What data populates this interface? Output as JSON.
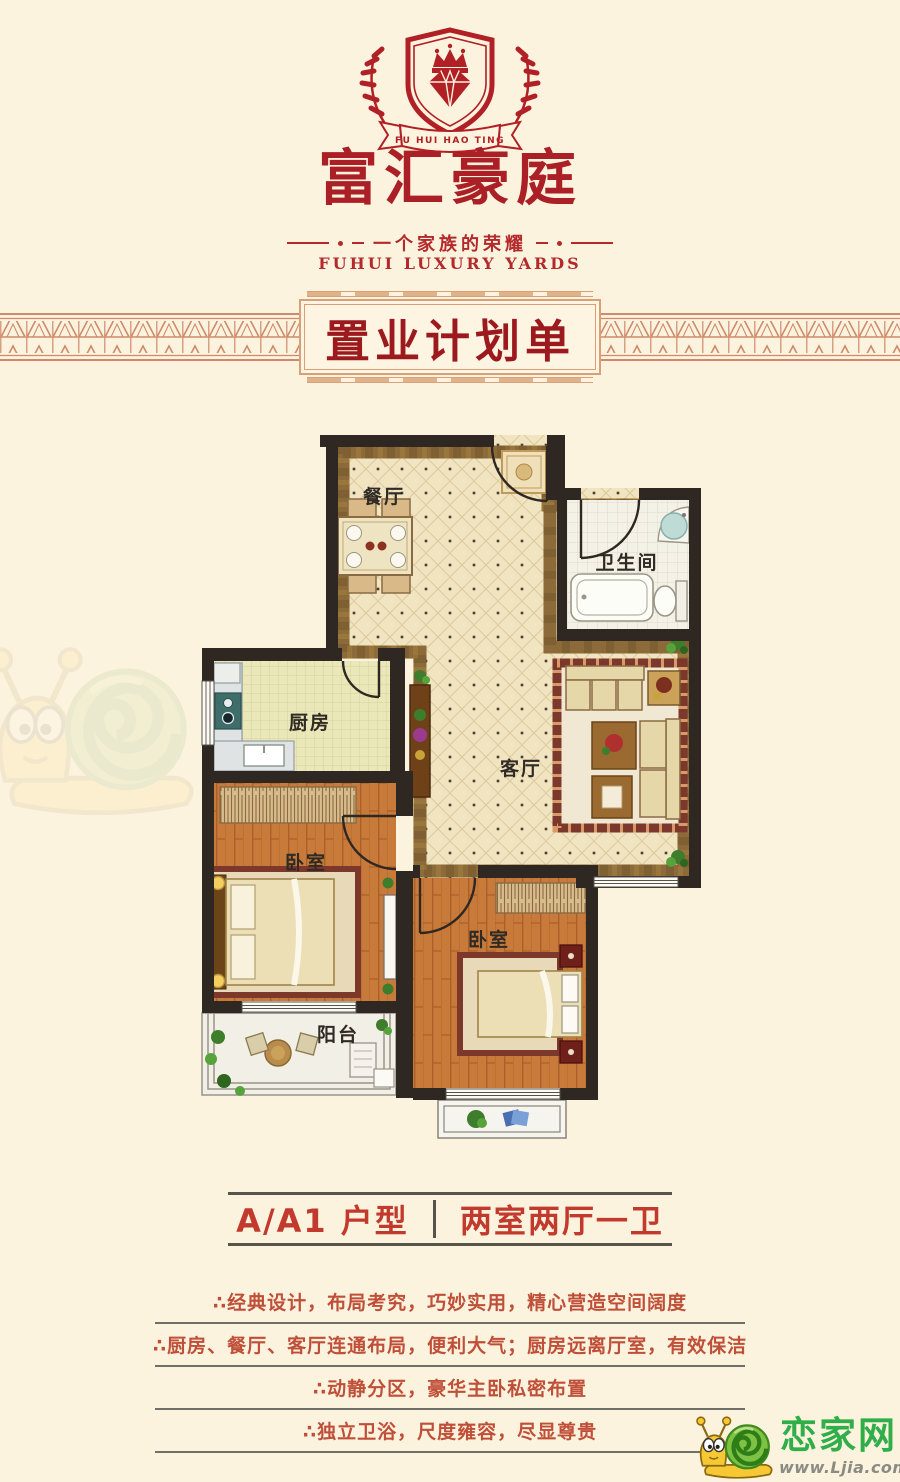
{
  "page": {
    "background": "#fcf3de"
  },
  "logo": {
    "ribbon_text": "FU HUI HAO TING",
    "brand_name": "富汇豪庭",
    "tagline": "一个家族的荣耀",
    "tagline_en": "FUHUI LUXURY YARDS",
    "brand_red": "#ab2026"
  },
  "banner": {
    "title": "置业计划单",
    "text_color": "#9c1a1e",
    "frame_color": "#d8a077",
    "band_color": "#cf8a6c"
  },
  "floorplan": {
    "wall_color": "#2f2822",
    "rooms": [
      {
        "id": "dining",
        "label": "餐厅"
      },
      {
        "id": "bathroom",
        "label": "卫生间"
      },
      {
        "id": "kitchen",
        "label": "厨房"
      },
      {
        "id": "living",
        "label": "客厅"
      },
      {
        "id": "bedroom-main",
        "label": "卧室"
      },
      {
        "id": "bedroom-second",
        "label": "卧室"
      },
      {
        "id": "balcony",
        "label": "阳台"
      }
    ]
  },
  "unit_info": {
    "unit_name": "A/A1 户型",
    "layout": "两室两厅一卫"
  },
  "features": [
    "∴经典设计，布局考究，巧妙实用，精心营造空间阔度",
    "∴厨房、餐厅、客厅连通布局，便利大气；厨房远离厅室，有效保洁",
    "∴动静分区，豪华主卧私密布置",
    "∴独立卫浴，尺度雍容，尽显尊贵"
  ],
  "watermark": {
    "site_name": "恋家网",
    "site_url": "www.Ljia.com",
    "green": "#2fae49"
  }
}
